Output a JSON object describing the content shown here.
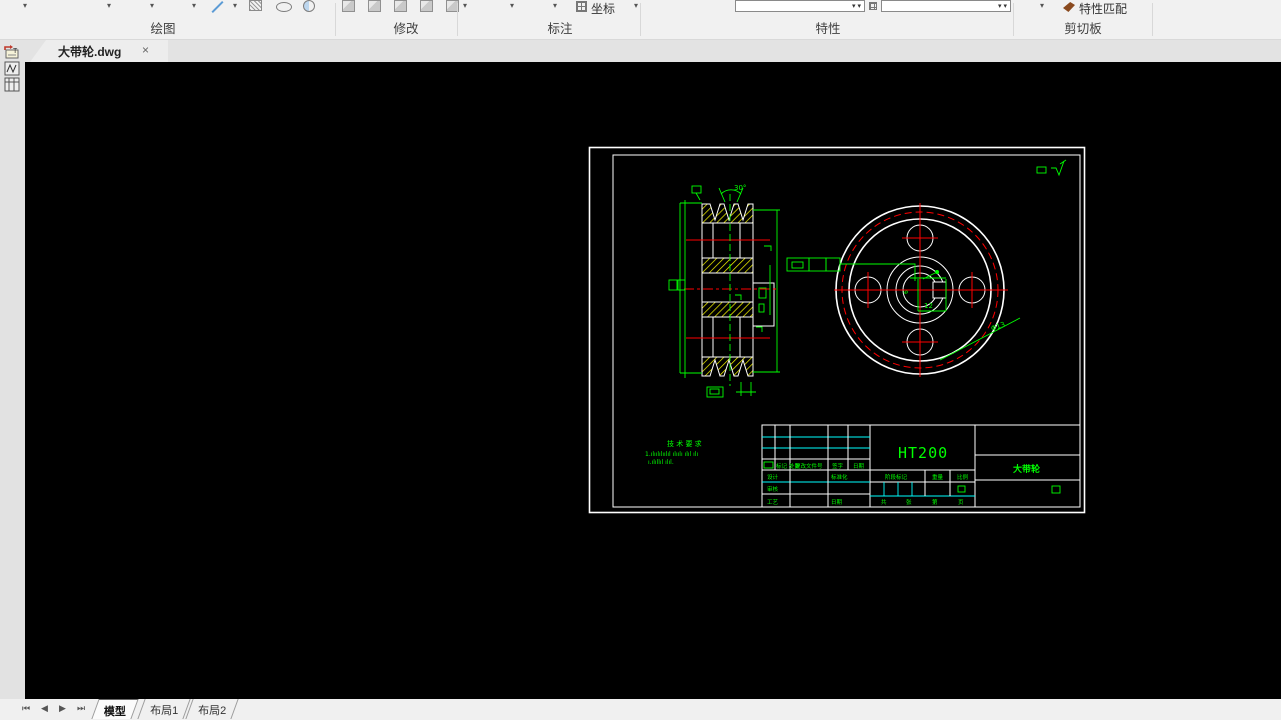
{
  "colors": {
    "canvas_bg": "#000000",
    "line_white": "#ffffff",
    "annotation_green": "#00ff00",
    "centerline_red": "#ff0000",
    "hatch_yellow": "#ffff00",
    "table_cyan": "#00ffff",
    "ribbon_bg": "#f1f1f1"
  },
  "ribbon": {
    "panels": [
      {
        "label": "绘图"
      },
      {
        "label": "修改"
      },
      {
        "label": "标注"
      },
      {
        "label": "特性"
      },
      {
        "label": "剪切板"
      }
    ],
    "coord_button": "坐标",
    "match_properties_button": "特性匹配"
  },
  "doc_tabs": {
    "active_title": "大带轮.dwg",
    "close_glyph": "×"
  },
  "drawing": {
    "material": "HT200",
    "part_name": "大带轮",
    "tech_requirements": {
      "title": "技 术 要 求",
      "line1": "1.ılıılılıılıl ılıılı ılıl ılı",
      "line2": "ı.ılıllıl ılıl."
    },
    "dimensions": {
      "groove_angle": "30°",
      "keyway_depth": "6",
      "keyway_width": "12",
      "bolt_hole_dia": "Φ13"
    },
    "title_block": {
      "mark": "标记",
      "count": "处数",
      "change_file": "更改文件号",
      "sign": "签字",
      "date": "日期",
      "design": "设计",
      "check": "审核",
      "process": "工艺",
      "standardize": "标准化",
      "date2": "日期",
      "stage_mark": "阶段标记",
      "weight": "重量",
      "scale": "比例",
      "total": "共",
      "sheets": "张",
      "page_no": "第",
      "page": "页"
    }
  },
  "sheet_bar": {
    "nav_first": "⏮",
    "nav_prev": "◀",
    "nav_next": "▶",
    "nav_last": "⏭",
    "tabs": [
      {
        "label": "模型"
      },
      {
        "label": "布局1"
      },
      {
        "label": "布局2"
      }
    ]
  }
}
